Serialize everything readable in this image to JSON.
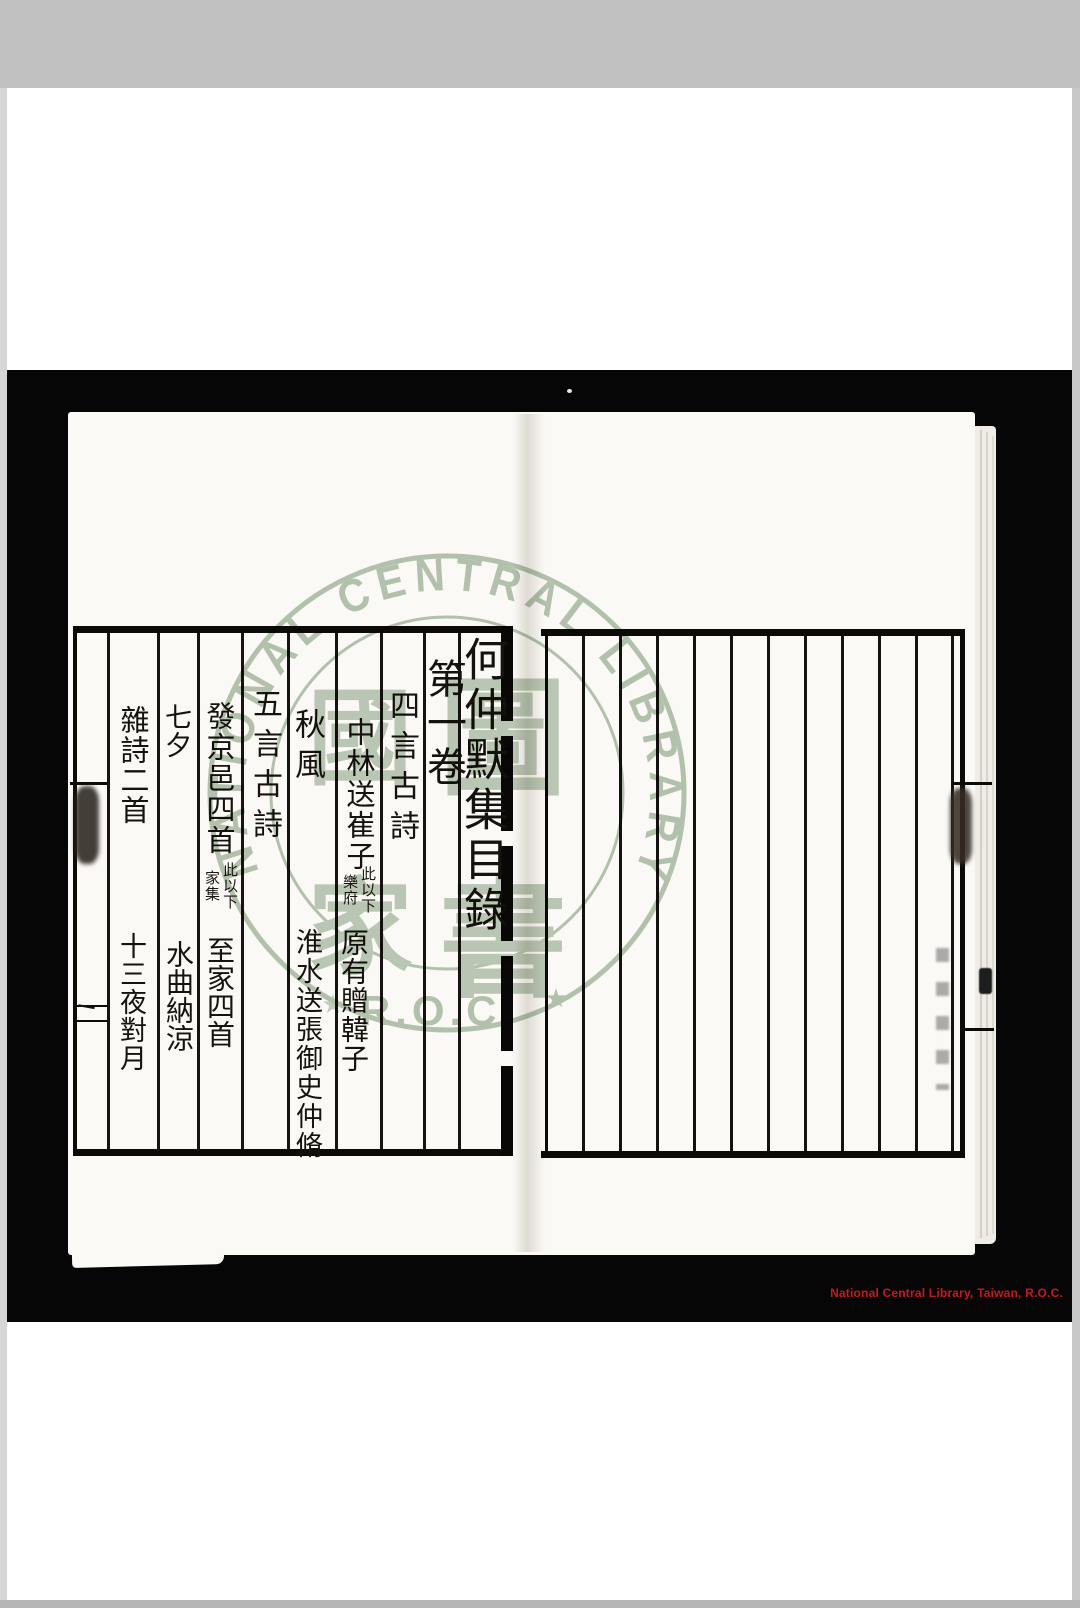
{
  "scan": {
    "matte_color": "#c1c1c1",
    "background_color": "#060606",
    "page_color": "#fbf9f5"
  },
  "credit": {
    "text": "National Central Library, Taiwan, R.O.C.",
    "color": "#cc1717"
  },
  "watermark": {
    "ring_text": "NATIONAL CENTRAL LIBRARY",
    "bottom_text": "R.O.C.",
    "star": "★",
    "seal_text": "國家圖書館",
    "seal_c1": "國",
    "seal_c2": "家",
    "seal_c3": "圖",
    "seal_c4": "書",
    "color": "#9fb69c"
  },
  "toc": {
    "title": "何仲默集目錄",
    "volume": "第一卷",
    "section1": "四言古詩",
    "section2": "五言古詩",
    "entries": {
      "e1": "中林送崔子",
      "e1_note_a": "此以下",
      "e1_note_b": "樂府",
      "e2": "原有贈韓子",
      "e3": "秋風",
      "e4": "淮水送張御史仲脩",
      "e5": "發京邑四首",
      "e5_note_a": "此以下",
      "e5_note_b": "家集",
      "e6": "至家四首",
      "e7": "七夕",
      "e8": "水曲納涼",
      "e9": "雜詩二首",
      "e10": "十三夜對月",
      "folio": "一"
    }
  }
}
